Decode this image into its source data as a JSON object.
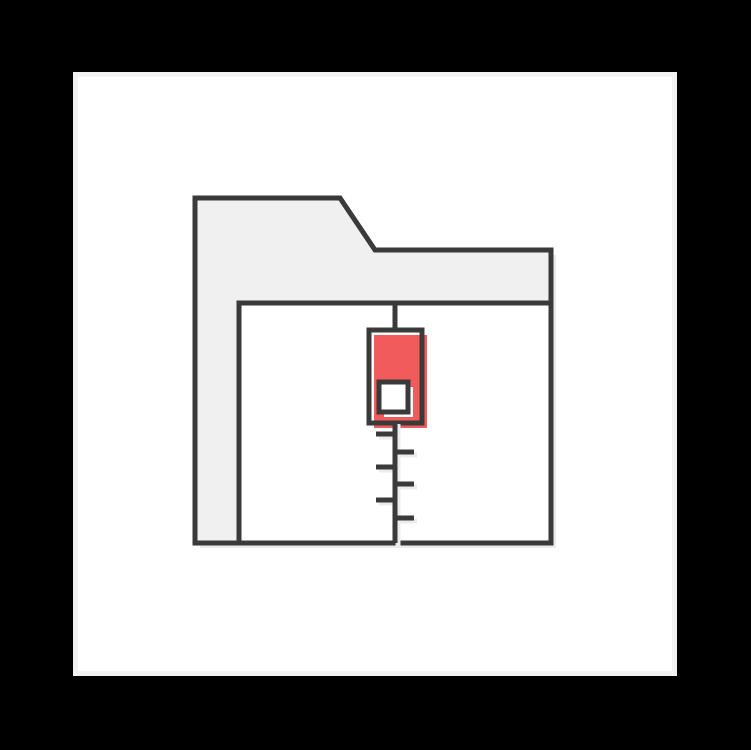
{
  "scene": {
    "background_color": "#000000",
    "card": {
      "background_color": "#ffffff",
      "rim_color": "#f2f2f2"
    },
    "icon": {
      "name": "zipped-folder-icon",
      "outline_color": "#3a3a3a",
      "folder_fill_color": "#f0f0f0",
      "front_panel_fill_color": "#ffffff",
      "shadow_color": "#ececec",
      "zipper_pull_accent_color": "#f25b5b",
      "slider_window_fill_color": "#ffffff"
    }
  }
}
